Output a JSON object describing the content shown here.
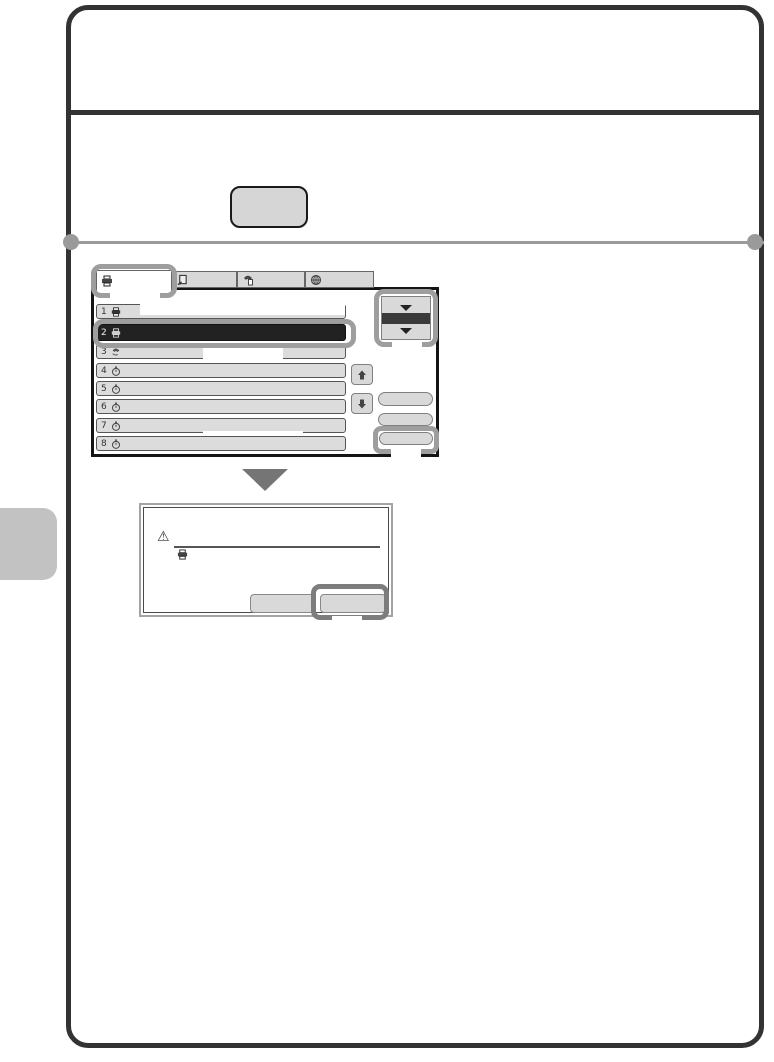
{
  "page": {
    "frame_color": "#333333",
    "callout_color": "#9e9e9e",
    "dialog_callout_color": "#7d7d7d",
    "button_fill": "#d9d9d9",
    "selected_row_fill": "#222222",
    "hardware_key_label": ""
  },
  "touch_panel": {
    "tabs": [
      {
        "icon": "printer-icon",
        "label": "",
        "active": true
      },
      {
        "icon": "document-send-icon",
        "label": "",
        "active": false
      },
      {
        "icon": "fax-phone-icon",
        "label": "",
        "active": false
      },
      {
        "icon": "internet-fax-globe-icon",
        "label": "",
        "active": false
      }
    ],
    "queue_rows": [
      {
        "number": "1",
        "icon": "print-job-icon",
        "selected": false
      },
      {
        "number": "2",
        "icon": "print-job-icon",
        "selected": true
      },
      {
        "number": "3",
        "icon": "phone-job-icon",
        "selected": false
      },
      {
        "number": "4",
        "icon": "waiting-timer-icon",
        "selected": false
      },
      {
        "number": "5",
        "icon": "waiting-timer-icon",
        "selected": false
      },
      {
        "number": "6",
        "icon": "waiting-timer-icon",
        "selected": false
      },
      {
        "number": "7",
        "icon": "waiting-timer-icon",
        "selected": false
      },
      {
        "number": "8",
        "icon": "waiting-timer-icon",
        "selected": false
      }
    ],
    "scroll_selector": {
      "icon": "double-down-triangles",
      "bar_color": "#3a3a3a"
    },
    "up_key": {
      "icon": "up-arrow-icon",
      "label": ""
    },
    "down_key": {
      "icon": "down-arrow-icon",
      "label": ""
    },
    "side_buttons": [
      {
        "label": ""
      },
      {
        "label": ""
      },
      {
        "label": "",
        "highlighted": true
      }
    ]
  },
  "dialog": {
    "warning_icon": "⚠",
    "message_text": "",
    "job_icon": "print-job-icon",
    "buttons": [
      {
        "label": ""
      },
      {
        "label": "",
        "highlighted": true
      }
    ]
  }
}
